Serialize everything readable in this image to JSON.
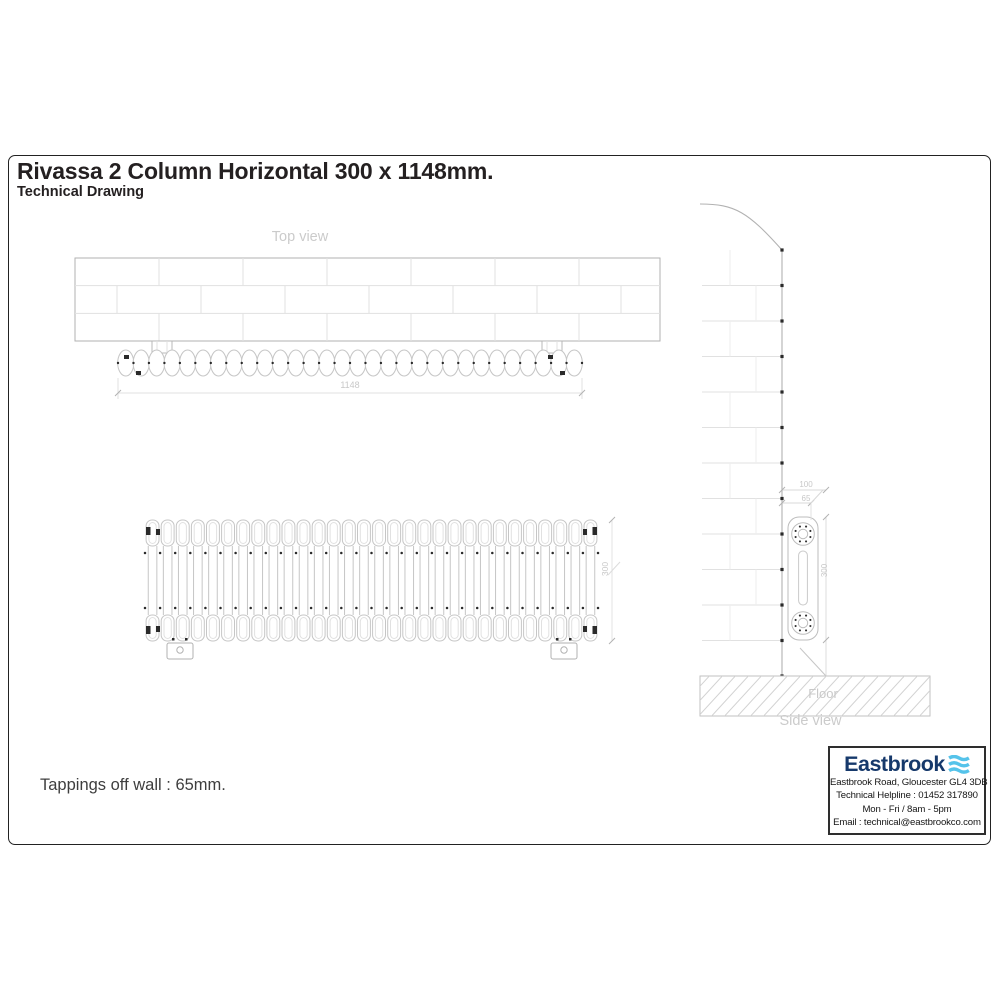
{
  "page": {
    "title": "Rivassa 2 Column Horizontal 300 x 1148mm.",
    "subtitle": "Technical Drawing",
    "note": "Tappings off wall : 65mm."
  },
  "views": {
    "top": {
      "label": "Top view",
      "dim_length": "1148"
    },
    "front": {
      "dim_height": "300"
    },
    "side": {
      "label": "Side view",
      "floor": "Floor",
      "dim_off_wall_outer": "100",
      "dim_off_wall": "65",
      "dim_height": "300"
    }
  },
  "drawing": {
    "sections": 30,
    "line": "#c6c6c6",
    "faint": "#e1e1e1",
    "mid": "#b2b2b2",
    "dark": "#2a2a2a",
    "label": "#c8c8c8"
  },
  "infobox": {
    "brand": "Eastbrook",
    "address": "Eastbrook Road, Gloucester GL4 3DB",
    "helpline": "Technical Helpline : 01452 317890",
    "hours": "Mon - Fri / 8am - 5pm",
    "email": "Email : technical@eastbrookco.com",
    "brand_color": "#16396b",
    "wave_color": "#55c3ea"
  }
}
